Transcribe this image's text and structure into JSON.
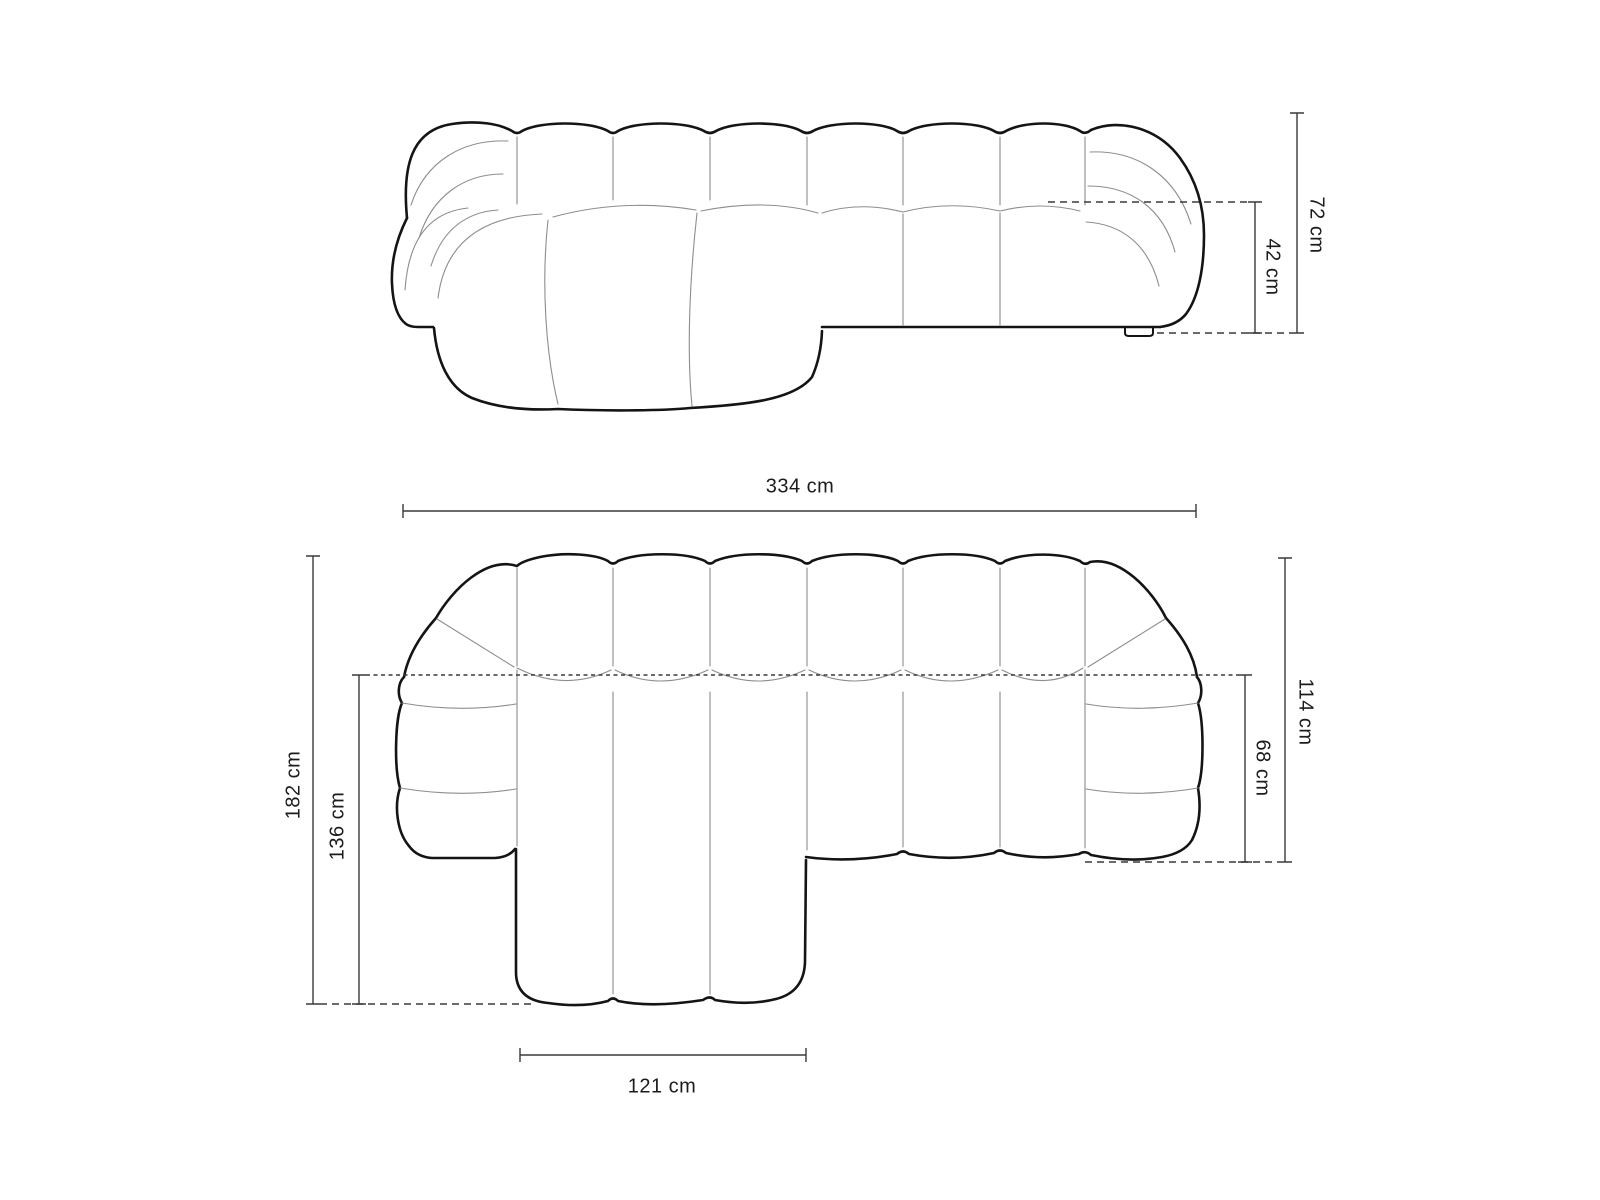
{
  "diagram": {
    "front_view": {
      "height_total": "72 cm",
      "seat_height": "42 cm"
    },
    "plan_view": {
      "width_total": "334 cm",
      "depth_total": "182 cm",
      "chaise_depth": "136 cm",
      "body_depth": "114 cm",
      "seat_depth": "68 cm",
      "chaise_width": "121 cm"
    },
    "colors": {
      "background": "#ffffff",
      "outline": "#141414",
      "seam": "#8d8d8d",
      "dimension": "#3a3a3a",
      "text": "#1c1c1c"
    }
  }
}
